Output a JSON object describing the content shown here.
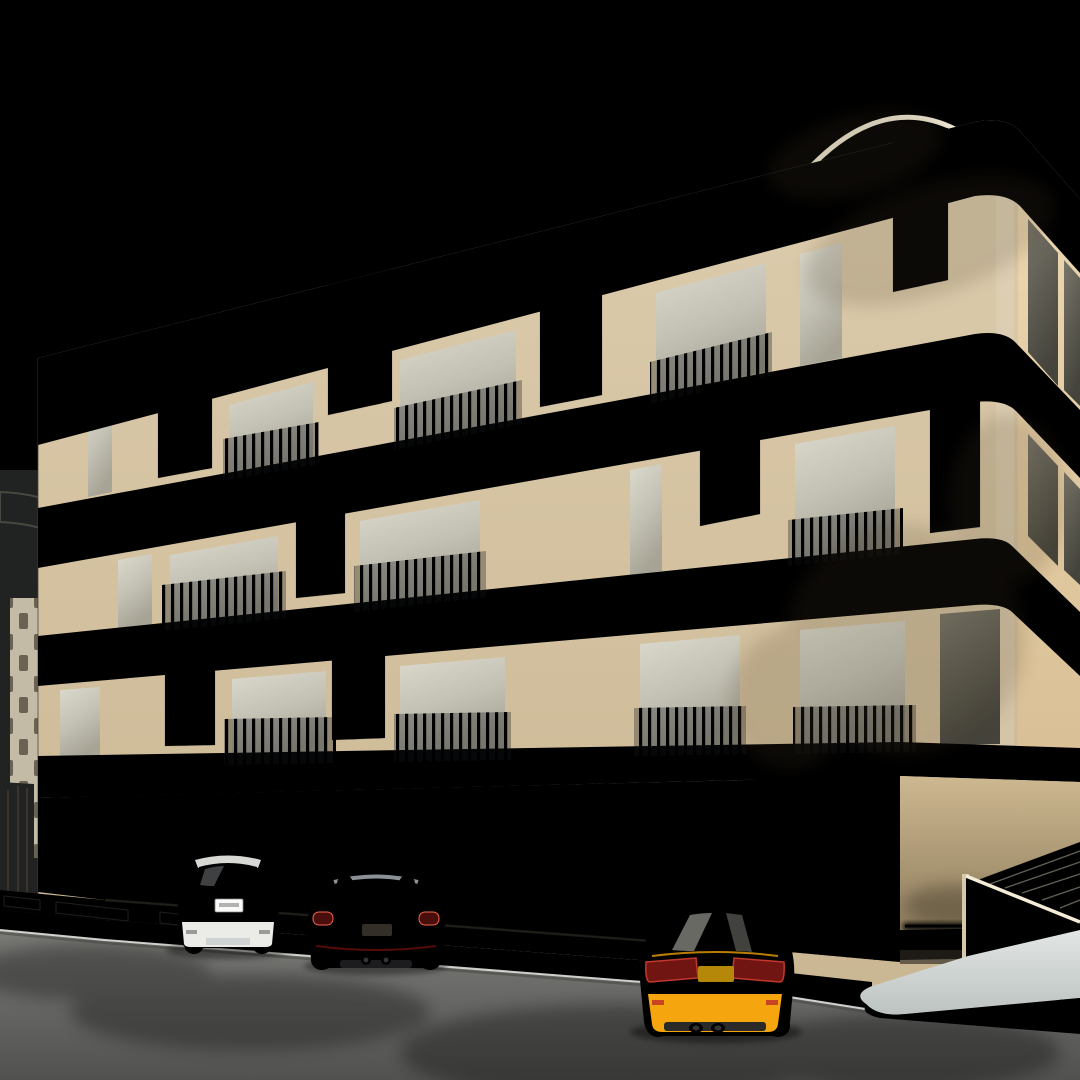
{
  "scene": {
    "type": "architectural-exterior-rendering",
    "subject": "three-storey residential building with street parking"
  },
  "colors": {
    "sky_top": "#6f8da3",
    "sky_mid": "#93aab5",
    "sky_low": "#c8d3d2",
    "cloud": "#e6edef",
    "contrail": "#e6edf2",
    "bird": "#e9efef",
    "band": "#f2ebd8",
    "trim": "#2a2a28",
    "facade": "#d7c6a5",
    "facade_right": "#e5cda6",
    "facade_dark": "#a4916f",
    "panel": "#d3c19d",
    "panel_slot": "#55493a",
    "frame": "#1d1d1f",
    "glass": "#c9c7bc",
    "glass_dark": "#6a675e",
    "railing": "#22252b",
    "slat_bg": "#15161b",
    "slat_bar": "#b8b0a0",
    "gate_bg": "#0b0c10",
    "gate_bar": "#26272e",
    "bg_building": "#c9bda3",
    "bg_band": "#efe9d8",
    "bg_brown": "#6e4c34",
    "entr_wall": "#c7b28c",
    "led": "#ffd98c",
    "led_core": "#fff6dc",
    "recess": "#e9e1cd",
    "parapet_wall": "#e9ddc1",
    "slab": "#ccd1cf",
    "slab_edge": "#a9afaf",
    "paver": "#9a958a",
    "road": "#6f6f6d",
    "road_dark": "#565755",
    "sidewalk": "#b7bab6",
    "line_white": "#e9e9e4",
    "gravel": "#8d8476",
    "curb_yellow": "#d2a52c",
    "curb_black": "#2b2b28",
    "trunk": "#4d3b28",
    "arch": "#d8c4a0",
    "car_white": "#f3f3f0",
    "suv_glass": "#2e3236",
    "tail_red": "#8a2420",
    "car_red": "#cf2015",
    "car_red_dark": "#8e120d",
    "car_red_hi": "#f4644a",
    "car_yellow": "#ffb321",
    "car_yellow_dark": "#e89c04",
    "sedan_glass": "#3c4036",
    "tire": "#1b1d20",
    "chrome": "#c9c9c4",
    "headrest": "#b9b7b0",
    "seat_dark": "#1c1c1e"
  },
  "palettes": {
    "tree_yellow": [
      "#b7c04c",
      "#a9b23c",
      "#c8d160",
      "#97a233",
      "#d4dc78"
    ],
    "tree_green": [
      "#3d5038",
      "#314331",
      "#4a5e41",
      "#2b392b"
    ],
    "bush": [
      "#6b7140",
      "#575d33",
      "#7a8150"
    ],
    "grass": [
      "#b8a06b",
      "#927c50",
      "#cdb67e"
    ],
    "palm": [
      "#2e3a2b",
      "#3c4c34",
      "#24301f"
    ],
    "palm_gold": [
      "#8a6a2f",
      "#a8823a",
      "#6b5226"
    ],
    "leaf_litter": [
      "#c2a23f",
      "#8a6a2f",
      "#d8b84e"
    ]
  },
  "sky": {
    "birds": [
      [
        412,
        156
      ],
      [
        54,
        220
      ]
    ],
    "contrail": [
      140,
      -12,
      1150,
      148
    ],
    "clouds": [
      [
        70,
        340,
        130,
        30,
        0.5
      ],
      [
        185,
        505,
        150,
        26,
        0.42
      ],
      [
        120,
        430,
        95,
        22,
        0.32
      ],
      [
        30,
        560,
        120,
        22,
        0.45
      ]
    ]
  },
  "vegetation": {
    "trees": [
      {
        "name": "street-tree-left",
        "x": 150,
        "y": 750,
        "rx": 100,
        "ry": 86,
        "palette": "tree_yellow",
        "n": 170,
        "trunk": true
      },
      {
        "name": "street-tree-small",
        "x": 300,
        "y": 832,
        "rx": 48,
        "ry": 40,
        "palette": "tree_yellow",
        "n": 70,
        "trunk": true
      },
      {
        "name": "street-tree-center",
        "x": 455,
        "y": 756,
        "rx": 112,
        "ry": 102,
        "palette": "tree_yellow",
        "n": 210,
        "trunk": true
      },
      {
        "name": "evergreen-tree-upper",
        "x": 1042,
        "y": 560,
        "rx": 76,
        "ry": 128,
        "palette": "tree_green",
        "n": 220,
        "trunk": false
      },
      {
        "name": "evergreen-tree-lower",
        "x": 1006,
        "y": 724,
        "rx": 58,
        "ry": 66,
        "palette": "tree_green",
        "n": 100,
        "trunk": false
      }
    ],
    "bushes": [
      [
        55,
        888,
        26,
        11
      ],
      [
        118,
        893,
        18,
        9
      ],
      [
        210,
        900,
        30,
        12
      ],
      [
        335,
        910,
        26,
        11
      ],
      [
        565,
        936,
        34,
        12
      ],
      [
        700,
        948,
        30,
        11
      ],
      [
        640,
        942,
        20,
        9
      ]
    ],
    "grasses": [
      [
        18,
        900
      ],
      [
        64,
        904
      ],
      [
        112,
        908
      ],
      [
        160,
        912
      ],
      [
        206,
        916
      ],
      [
        252,
        919
      ],
      [
        300,
        922
      ],
      [
        346,
        926
      ],
      [
        394,
        929
      ],
      [
        442,
        932
      ],
      [
        490,
        936
      ],
      [
        536,
        939
      ],
      [
        584,
        943
      ],
      [
        630,
        946
      ],
      [
        680,
        950
      ],
      [
        80,
        905
      ],
      [
        510,
        937
      ],
      [
        560,
        940
      ]
    ],
    "cacti": [
      [
        252,
        898,
        62,
        13
      ],
      [
        352,
        884,
        40,
        10
      ],
      [
        14,
        874,
        44,
        9
      ],
      [
        567,
        905,
        80,
        13
      ]
    ]
  },
  "palm": {
    "fronds": [
      [
        648,
        -28,
        690,
        70,
        846,
        158,
        26,
        0.2
      ],
      [
        770,
        -36,
        868,
        86,
        1016,
        216,
        28,
        0.25
      ],
      [
        906,
        -44,
        1000,
        120,
        1082,
        306,
        26,
        0.45
      ],
      [
        1010,
        -36,
        1040,
        180,
        1084,
        368,
        24,
        0.5
      ],
      [
        836,
        -20,
        858,
        46,
        940,
        104,
        18,
        0.3
      ],
      [
        1086,
        40,
        1000,
        70,
        902,
        150,
        22,
        0.35
      ]
    ],
    "tips": {
      "from": 596,
      "to": 840,
      "step": 9
    }
  },
  "ground": {
    "stall_lines": [
      [
        170,
        944,
        80,
        1012
      ],
      [
        330,
        958,
        246,
        1026
      ],
      [
        490,
        972,
        409,
        1040
      ],
      [
        640,
        985,
        560,
        1052
      ]
    ],
    "dash_line": [
      -30,
      990,
      1100,
      1062
    ],
    "litter": [
      [
        60,
        320,
        935,
        985,
        16
      ],
      [
        430,
        640,
        915,
        950,
        12
      ],
      [
        230,
        500,
        990,
        1025,
        9
      ]
    ],
    "xmarks": [
      [
        886,
        1007
      ],
      [
        926,
        1010
      ],
      [
        968,
        1014
      ],
      [
        1012,
        1018
      ],
      [
        1054,
        1022
      ]
    ]
  },
  "vehicles": [
    {
      "name": "white-suv",
      "color": "#f3f3f0"
    },
    {
      "name": "red-convertible",
      "color": "#cf2015"
    },
    {
      "name": "yellow-sedan",
      "color": "#ffb321"
    }
  ]
}
